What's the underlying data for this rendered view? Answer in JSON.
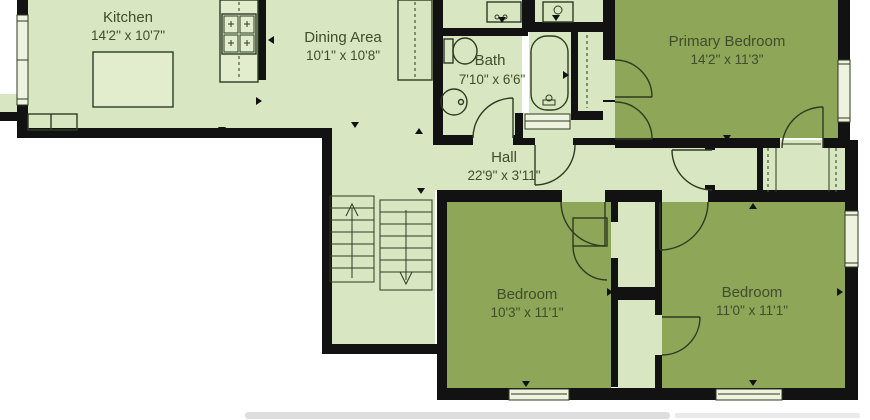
{
  "plan": {
    "rooms": [
      {
        "name": "Kitchen",
        "dims": "14'2\" x 10'7\""
      },
      {
        "name": "Dining Area",
        "dims": "10'1\" x 10'8\""
      },
      {
        "name": "Bath",
        "dims": "7'10\" x 6'6\""
      },
      {
        "name": "Primary Bedroom",
        "dims": "14'2\" x 11'3\""
      },
      {
        "name": "Hall",
        "dims": "22'9\" x 3'11\""
      },
      {
        "name": "Bedroom",
        "dims": "10'3\" x 11'1\""
      },
      {
        "name": "Bedroom",
        "dims": "11'0\" x 11'1\""
      }
    ],
    "fixtures": [
      "kitchen-island",
      "stove",
      "pantry",
      "staircase-up",
      "staircase-down",
      "toilet",
      "pedestal-sink",
      "bathtub",
      "washer",
      "dryer",
      "linen-closet",
      "wardrobe-closet",
      "window",
      "door"
    ],
    "colors": {
      "floor_light": "#d8e7c1",
      "floor_dark": "#8da657",
      "wall": "#121212",
      "label_text": "#414d2d",
      "window_fill": "#edf3df",
      "background": "#ffffff"
    }
  }
}
